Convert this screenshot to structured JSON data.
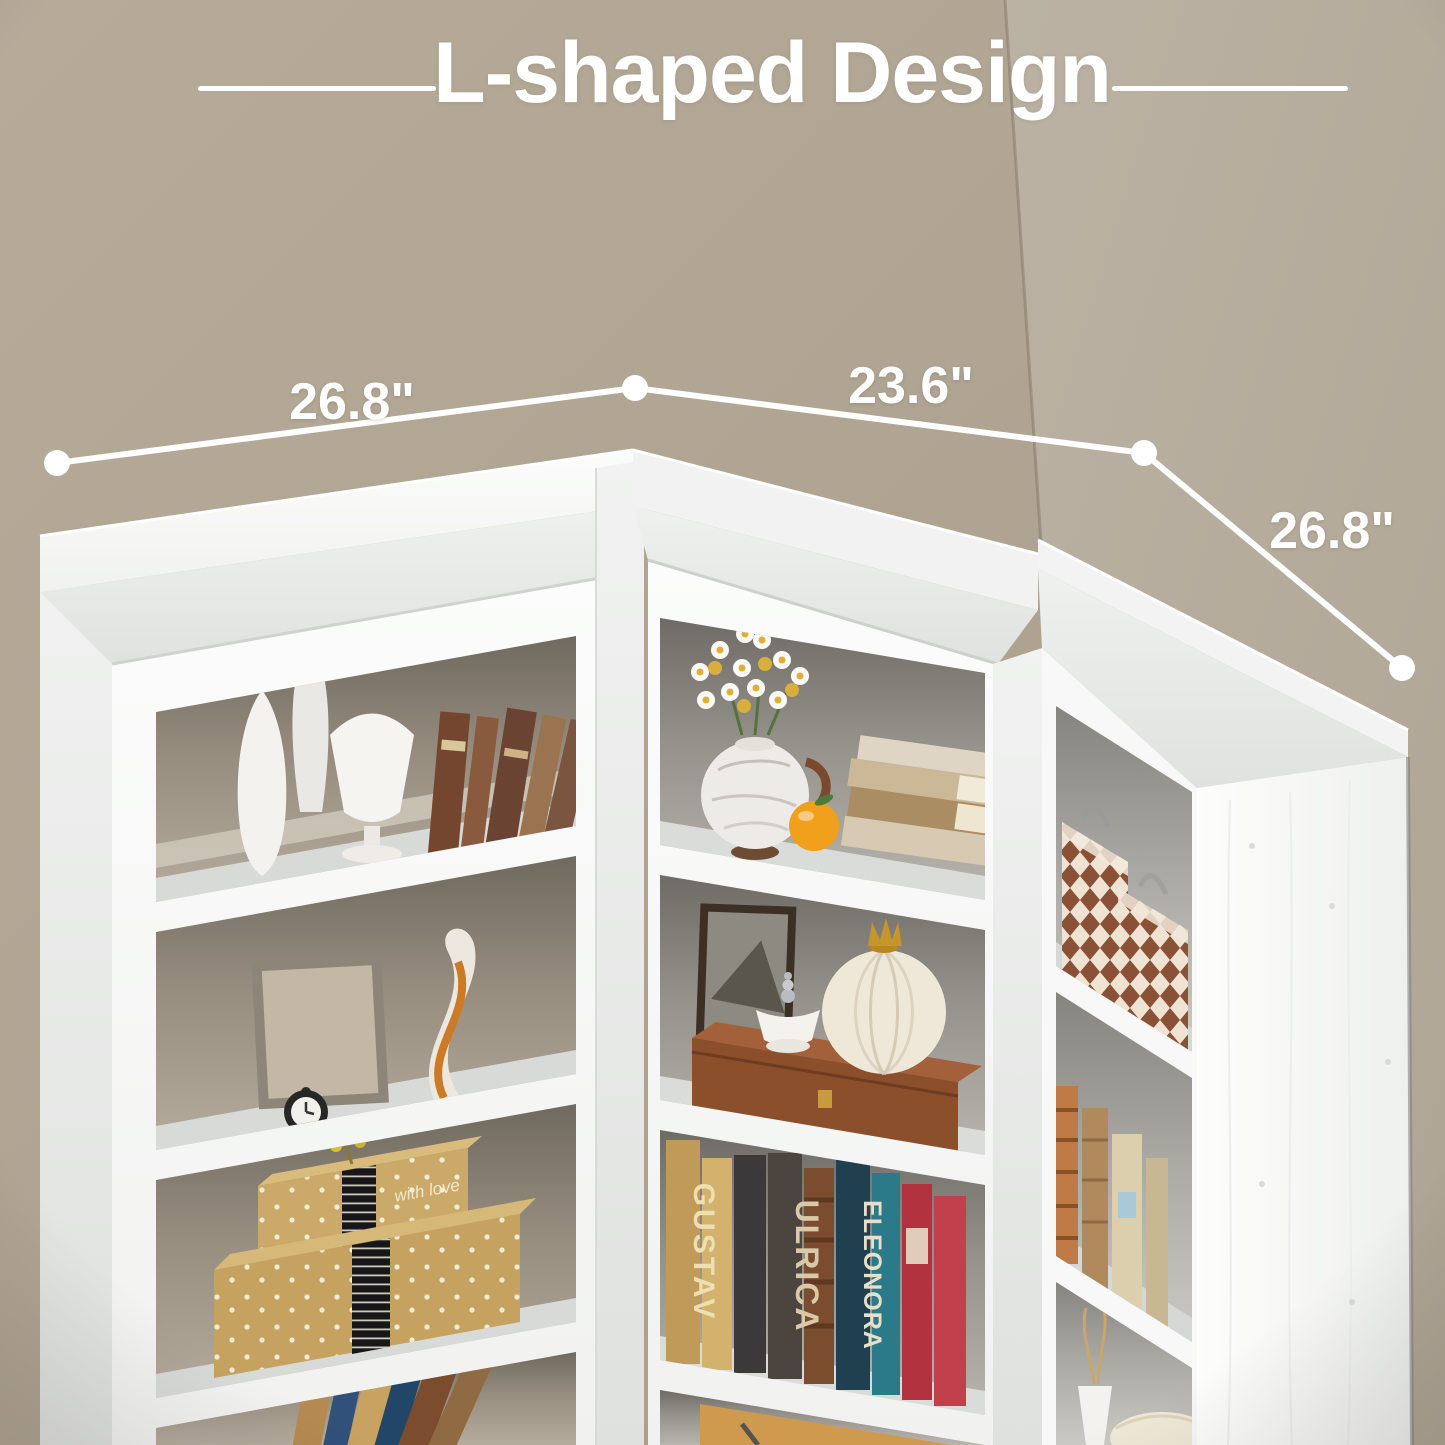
{
  "title": {
    "text": "L-shaped Design"
  },
  "dimensions": {
    "left_top": "26.8\"",
    "back_top": "23.6\"",
    "right_side": "26.8\""
  },
  "decor": {
    "book_spine_1": "GUSTAV",
    "book_spine_2": "ULRICA",
    "book_spine_3": "ELEONORA",
    "gift_box_text": "with love"
  },
  "palette": {
    "wall_left": "#afa492",
    "wall_right": "#b8afa0",
    "furniture_white": "#f8f9f8",
    "deck_gray": "#e8eae8",
    "interior_dark": "#6f695f",
    "interior_light": "#b6ac9e",
    "annotation_white": "#ffffff",
    "kraft_box": "#c6a261",
    "leather_chest": "#8b4f2b",
    "navy_book": "#20404f",
    "teal_book": "#2b7a8a",
    "red_book": "#b23240",
    "orange_fruit": "#f1a01c",
    "harlequin_brown": "#8a5136"
  }
}
